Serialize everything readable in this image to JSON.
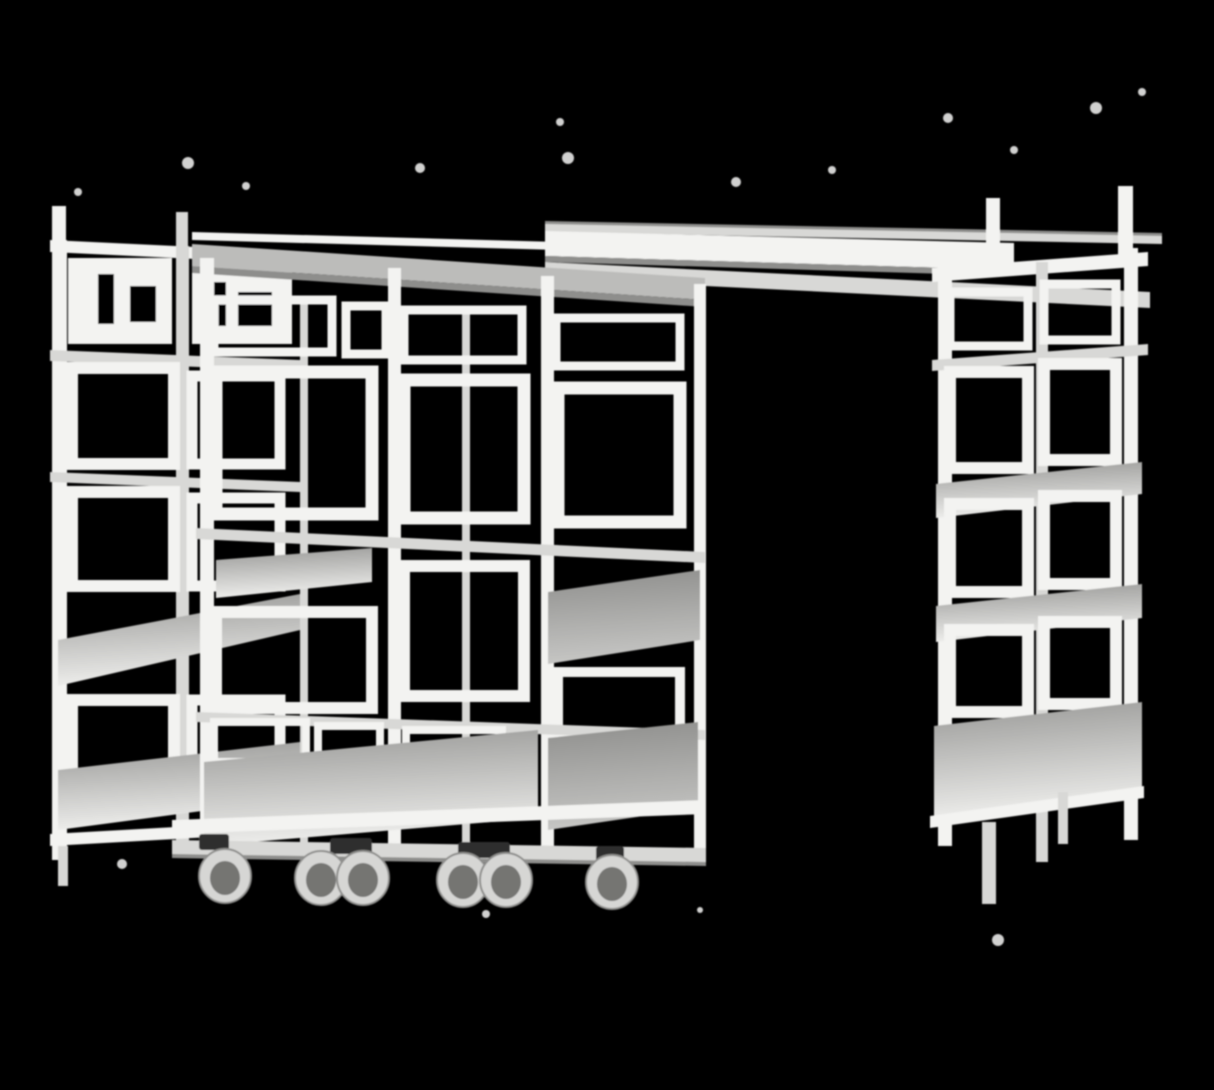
{
  "meta": {
    "domain": "natural-image",
    "description": "Black-and-white cut-out photograph of a modular metal shelving system: a tall stationary rack on the left, a row of mobile shelving carts on caster wheels in the middle, a long overhead connecting rail spanning an open aisle, and a tall shelving rack on the right, all on a solid black background with white cut-out speckle artifacts."
  },
  "scene": {
    "background": "#000000",
    "objects": [
      {
        "name": "left-rack",
        "kind": "stationary shelving rack",
        "shelf_levels": 5
      },
      {
        "name": "middle-racks",
        "kind": "mobile shelving carts on casters",
        "bays": 3,
        "caster_count": 6
      },
      {
        "name": "overhead-rail",
        "kind": "horizontal connecting rail over open aisle"
      },
      {
        "name": "right-rack",
        "kind": "tall shelving rack",
        "shelf_levels": 5
      }
    ],
    "palette": {
      "bg": "#000000",
      "frame-light": "#f3f3f1",
      "frame-mid": "#d8d8d6",
      "beam": "#bcbcba",
      "beam-dark": "#8e8e8c",
      "shelf-light": "#eeeeec",
      "shelf-mid": "#c6c6c4",
      "shelf-dark": "#989896",
      "wheel-rim": "#d6d6d4",
      "wheel-dark": "#747472",
      "stem": "#2f2f2f",
      "speck": "#f6f6f4"
    }
  }
}
